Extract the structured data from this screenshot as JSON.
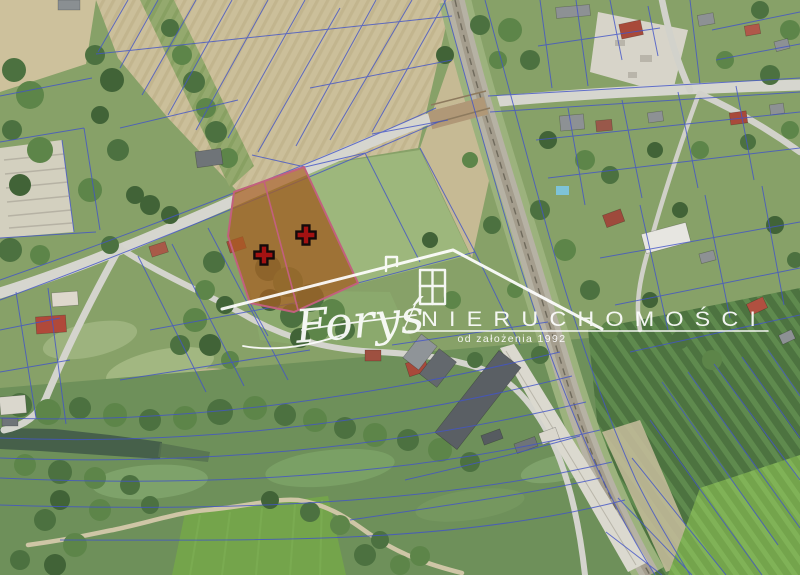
{
  "watermark": {
    "brand_script": "Foryś",
    "brand_main": "NIERUCHOMOŚCI",
    "tagline": "od założenia 1992",
    "color": "#ffffff",
    "house_icon": "house-outline-with-window"
  },
  "highlight": {
    "fill": "#a85f22",
    "fill_opacity": "0.72",
    "border": "#c2607e",
    "divider": "#c2607e",
    "marker_glyph": "plus-cross",
    "marker_fill": "#a31212",
    "marker_outline": "#140a0a",
    "markers": [
      {
        "name": "plot-marker-1",
        "transform": "translate(264,255)"
      },
      {
        "name": "plot-marker-2",
        "transform": "translate(306,235)"
      }
    ]
  },
  "cadastral": {
    "line_color": "#4254c8"
  }
}
